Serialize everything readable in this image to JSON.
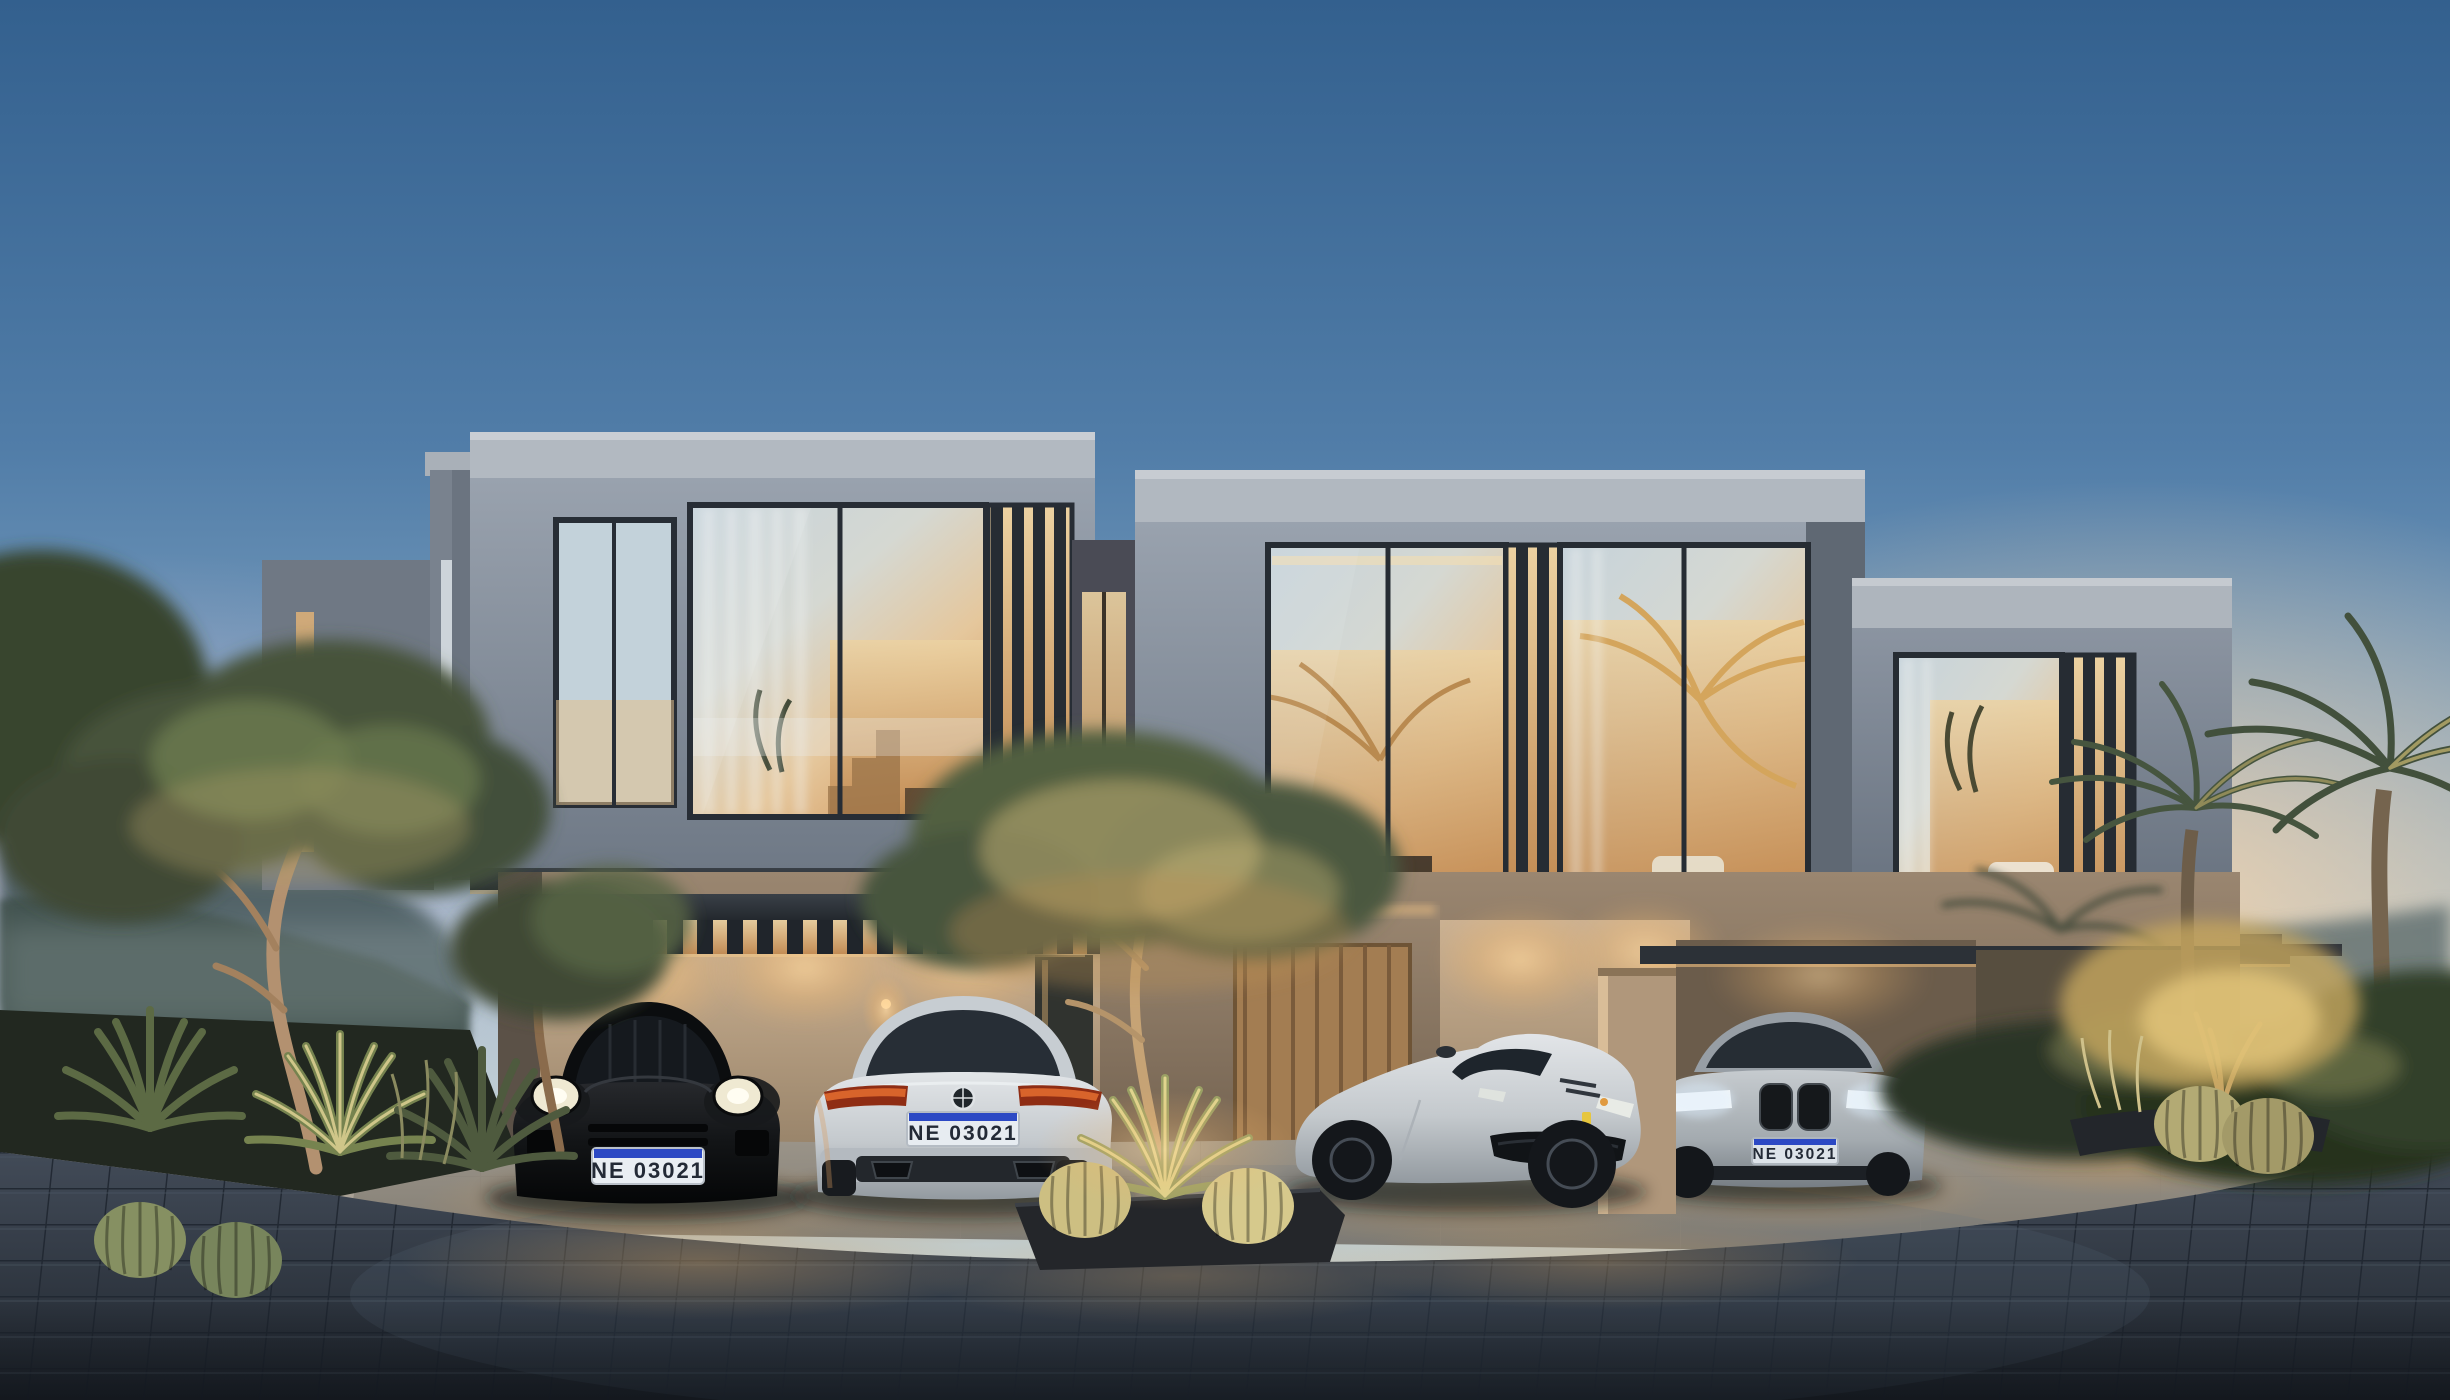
{
  "scene": {
    "type": "architectural_rendering",
    "time_of_day": "dusk",
    "description": "Photorealistic dusk rendering of a row of three modern two-storey townhouses with cantilevered glass upper cubes, vertical louver screens, warm-lit carports, four luxury cars parked in front, desert landscaping and a dark cobblestone driveway",
    "sky": "clear gradient sky, steel blue above, peach sunset glow at right horizon, lavender haze at left horizon"
  },
  "palette": {
    "sky_top": "#33608e",
    "sky_horizon": "#d8dfda",
    "sunset_peach": "#f9d6ac",
    "dusk_lavender": "#d9bed3",
    "concrete_fascia": "#b2b9c1",
    "concrete_face": "#8e97a3",
    "window_frame": "#272d35",
    "warm_interior": "#d9a368",
    "carport_wall_tan": "#c9ae90",
    "timber_door": "#a37d52",
    "paving_dark": "#333a45",
    "apron_light": "#9d9489",
    "foliage_dark": "#2f3a2e",
    "foliage_lit": "#d9c27e",
    "car_black": "#0d0f11",
    "car_silver": "#cfd3d6",
    "plate_white": "#e9eef3",
    "plate_band_blue": "#2c49c4",
    "tail_light_amber": "#e06a2e"
  },
  "building": {
    "storeys": 2,
    "upper_cubes": 3,
    "features": [
      "floor-to-ceiling glazing",
      "vertical louver screens",
      "sheer curtains",
      "warm interior lighting",
      "cantilevered slabs",
      "slatted carport pergola",
      "recessed lit entries"
    ]
  },
  "cars": [
    {
      "label": "black sports coupe",
      "view": "front",
      "body_color": "black",
      "plate": "NE 03021"
    },
    {
      "label": "silver coupe",
      "view": "rear",
      "body_color": "silver",
      "badge": "roundel",
      "plate": "NE 03021"
    },
    {
      "label": "silver grand tourer",
      "view": "three-quarter front",
      "body_color": "silver",
      "badge": "yellow prancing-horse badge"
    },
    {
      "label": "silver coupe",
      "view": "front",
      "body_color": "silver",
      "badge": "roundel",
      "plate": "NE 03021"
    }
  ],
  "landscaping": {
    "left": [
      "olive trees",
      "agave rosettes",
      "barrel cacti",
      "ornamental grasses",
      "hazy forested hills"
    ],
    "center": [
      "dark planter island",
      "olive tree",
      "uplit agave",
      "barrel cacti"
    ],
    "right": [
      "date palms",
      "dense shrubs",
      "uplit golden tree",
      "round cacti"
    ]
  }
}
